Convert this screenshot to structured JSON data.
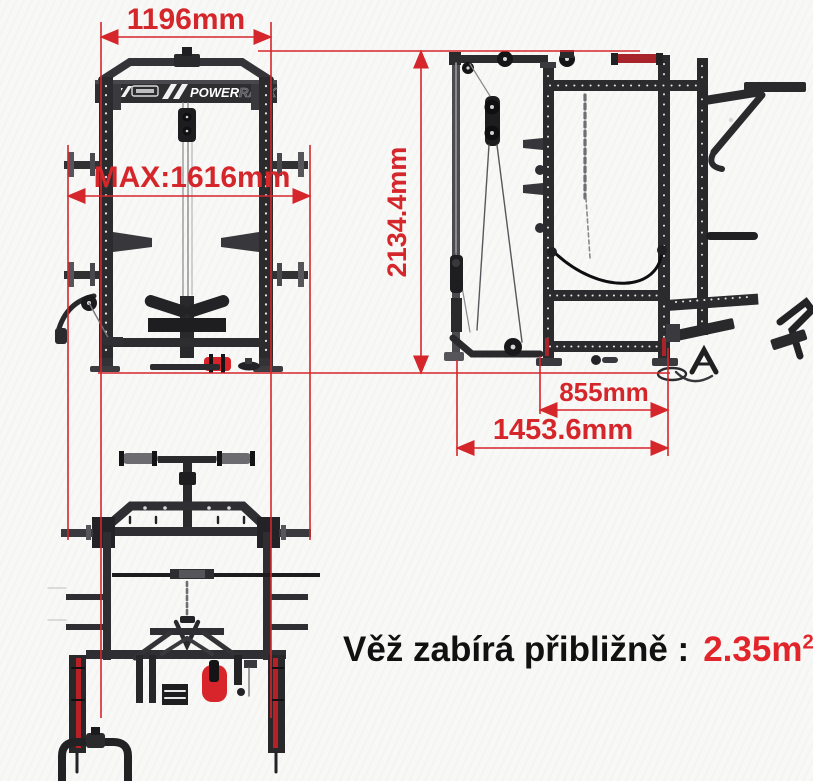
{
  "meta": {
    "accent_red": "#d5262b",
    "value_red": "#e1252b",
    "frame_dark": "#2b2b2e",
    "background": "#f8f8f7"
  },
  "dims": {
    "front_width": "1196mm",
    "max_width": "MAX:1616mm",
    "height": "2134.4mm",
    "depth_inner": "855mm",
    "depth_total": "1453.6mm"
  },
  "logo": {
    "power": "POWER",
    "rack": "RACK"
  },
  "caption": {
    "label": "Věž zabírá přibližně :",
    "value": "2.35m",
    "sup": "2"
  },
  "icons": {
    "brand-logo": "three-slash-stripes"
  }
}
